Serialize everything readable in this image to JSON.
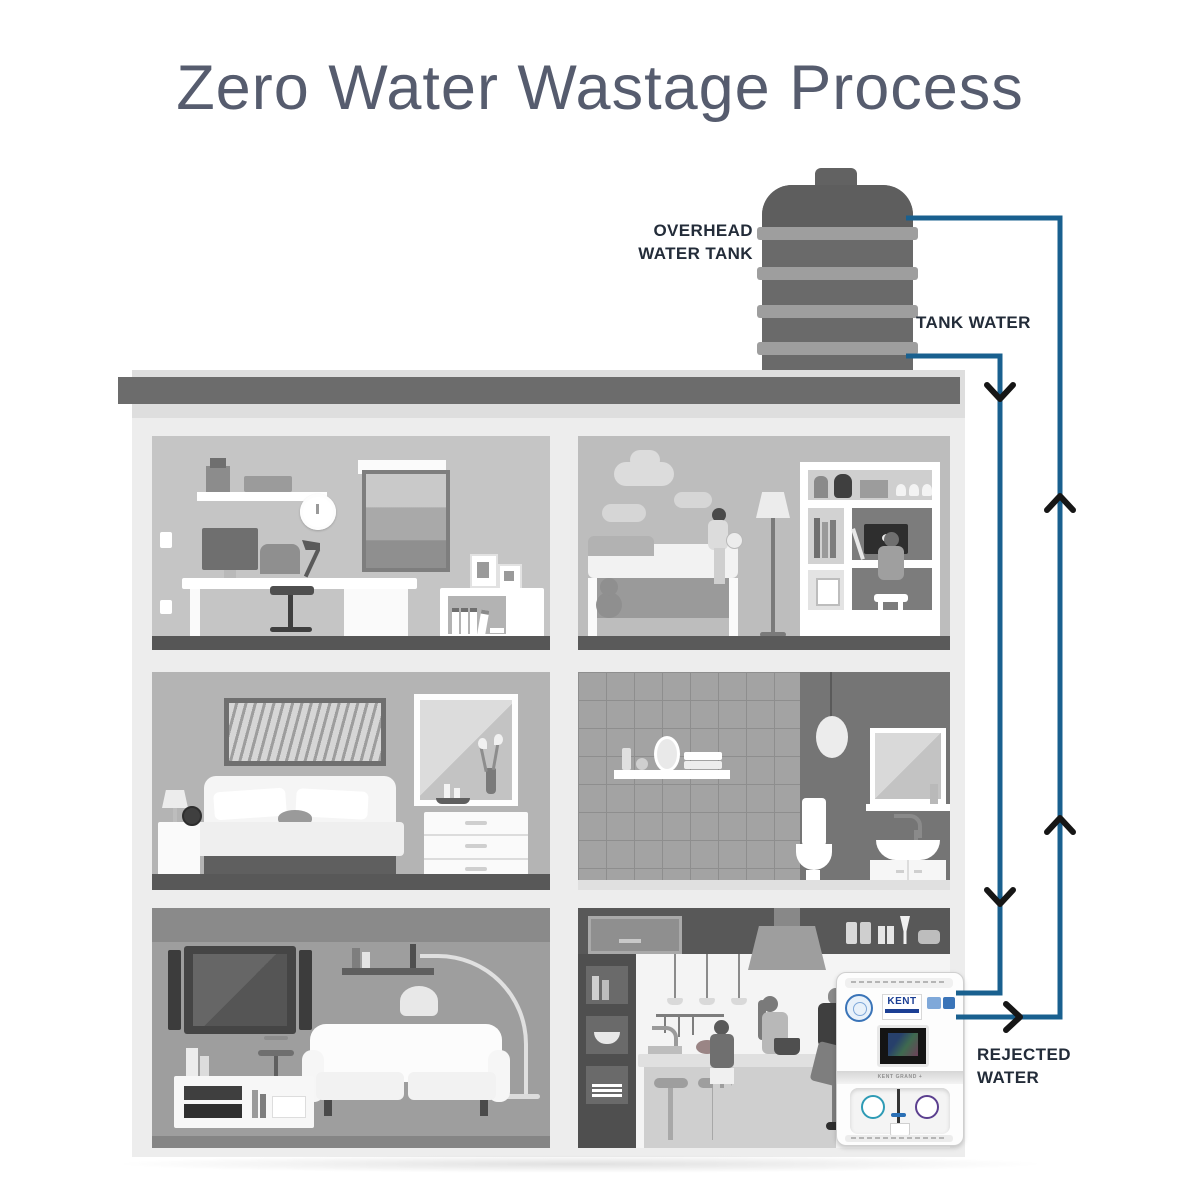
{
  "title": "Zero Water Wastage Process",
  "annotations": {
    "overhead_tank_line1": "OVERHEAD",
    "overhead_tank_line2": "WATER TANK",
    "tank_water": "TANK WATER",
    "rejected_line1": "REJECTED",
    "rejected_line2": "WATER"
  },
  "flows": {
    "tank_water": {
      "label": "TANK WATER",
      "direction": "down",
      "from": "overhead-water-tank",
      "to": "water-purifier"
    },
    "rejected_water": {
      "label": "REJECTED WATER",
      "direction": "up",
      "from": "water-purifier",
      "to": "overhead-water-tank"
    }
  },
  "purifier": {
    "brand": "KENT",
    "model_band": "KENT GRAND +"
  },
  "rooms": [
    {
      "name": "home-office",
      "floor": 3
    },
    {
      "name": "kids-room",
      "floor": 3
    },
    {
      "name": "bedroom",
      "floor": 2
    },
    {
      "name": "bathroom",
      "floor": 2
    },
    {
      "name": "living-room",
      "floor": 1
    },
    {
      "name": "kitchen",
      "floor": 1
    }
  ],
  "colors": {
    "pipe_blue": "#19608F",
    "arrow_black": "#161616",
    "title_text": "#565C6E",
    "label_text": "#232C39",
    "kent_blue": "#1C3F94",
    "tank_body": "#6A6A6A",
    "roof_band": "#6C6C6C"
  }
}
